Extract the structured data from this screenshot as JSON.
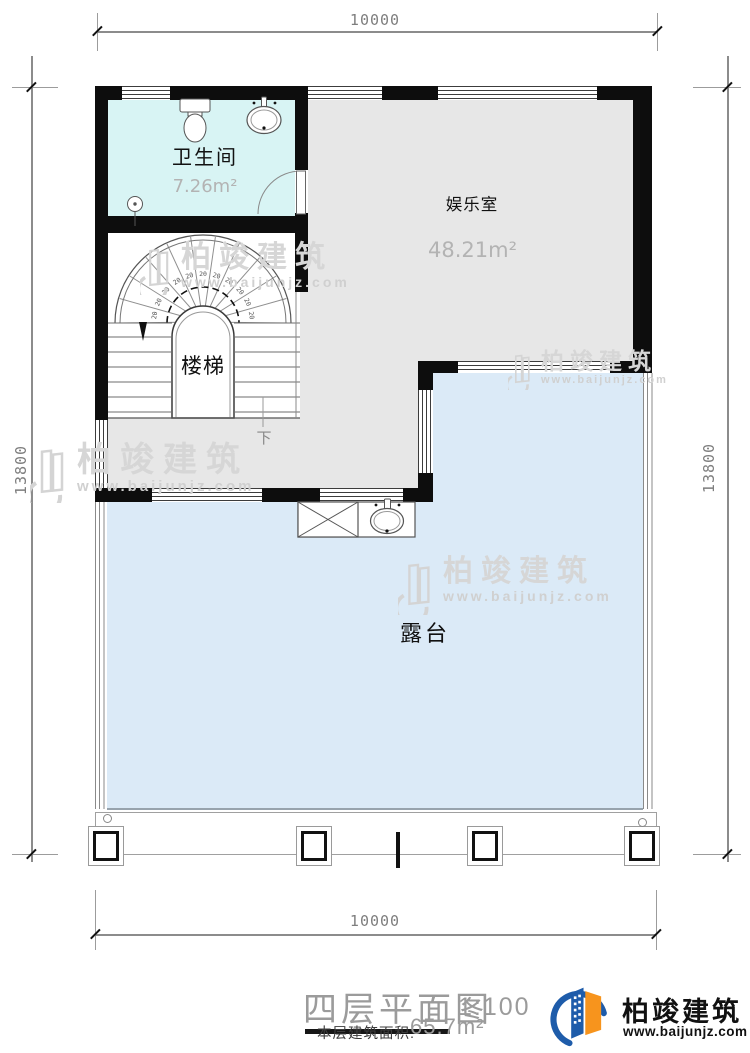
{
  "plan": {
    "dim_top": "10000",
    "dim_bottom": "10000",
    "dim_left": "13800",
    "dim_right": "13800",
    "rooms": {
      "bathroom": {
        "name": "卫生间",
        "area": "7.26m²"
      },
      "entertainment": {
        "name": "娱乐室",
        "area": "48.21m²"
      },
      "stairs": {
        "name": "楼梯",
        "down": "下",
        "tread": "20"
      },
      "terrace": {
        "name": "露台"
      }
    }
  },
  "title_block": {
    "title": "四层平面图",
    "scale": "1:100",
    "area_label": "本层建筑面积:",
    "area_value": "65.7m²"
  },
  "brand": {
    "name": "柏竣建筑",
    "website": "www.baijunjz.com"
  },
  "watermark": {
    "name": "柏竣建筑",
    "website": "www.baijunjz.com"
  },
  "colors": {
    "bathroom_floor": "#d8f4f4",
    "room_floor": "#e7e7e7",
    "terrace_floor": "#dbeaf7",
    "wall": "#0d0d0d",
    "logo_blue": "#1e5caa",
    "logo_orange": "#f7941d"
  }
}
